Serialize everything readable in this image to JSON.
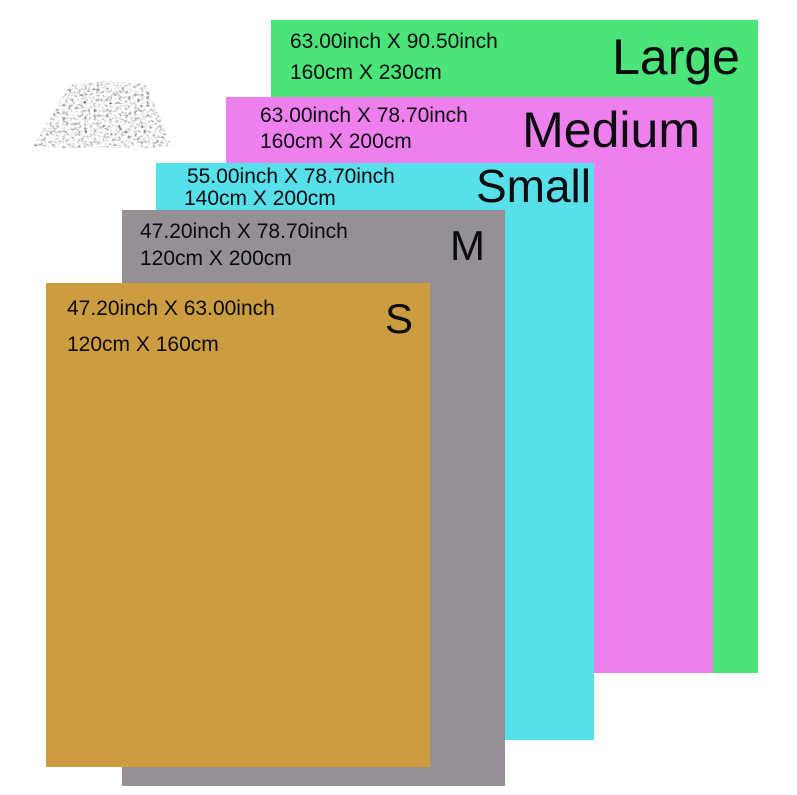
{
  "chart": {
    "name": "tarp-size-chart",
    "background": "#ffffff",
    "text_color": "#0b0b10"
  },
  "product_image": {
    "icon": "silver-speckled-tarp-photo",
    "colors": {
      "base": "#f4f4f4",
      "speckle": "#8a8a8a"
    }
  },
  "sizes": [
    {
      "label": "Large",
      "inch": "63.00inch X 90.50inch",
      "cm": "160cm X 230cm",
      "color": "#4be479"
    },
    {
      "label": "Medium",
      "inch": "63.00inch X 78.70inch",
      "cm": "160cm X 200cm",
      "color": "#ee80ee"
    },
    {
      "label": "Small",
      "inch": "55.00inch X 78.70inch",
      "cm": "140cm X 200cm",
      "color": "#57e0e9"
    },
    {
      "label": "M",
      "inch": "47.20inch X 78.70inch",
      "cm": "120cm X 200cm",
      "color": "#949094"
    },
    {
      "label": "S",
      "inch": "47.20inch X 63.00inch",
      "cm": "120cm X 160cm",
      "color": "#cb9d40"
    }
  ]
}
